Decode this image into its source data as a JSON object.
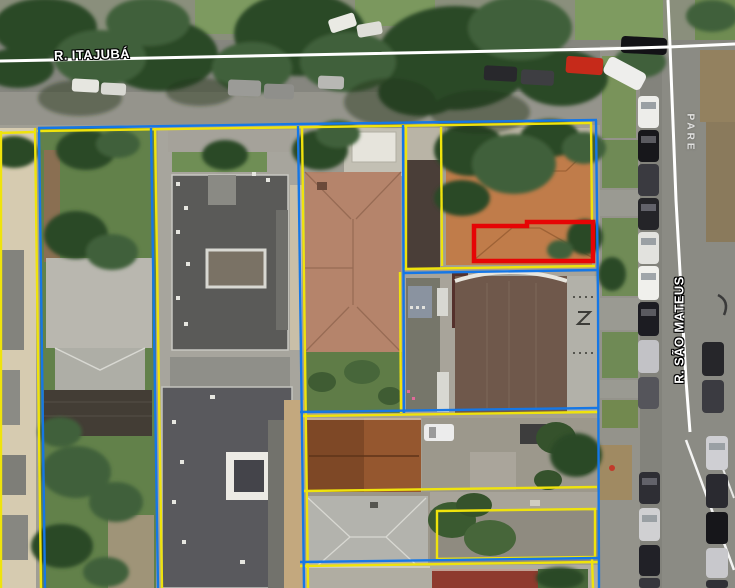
{
  "map": {
    "streets": {
      "horizontal": {
        "label": "R. ITAJUBÁ"
      },
      "vertical": {
        "label": "R. SÃO MATEUS"
      }
    },
    "road_markings": {
      "pare": "PARE"
    },
    "overlay_colors": {
      "parcel_blue": "#1577E6",
      "parcel_yellow": "#EFE30C",
      "selected_red": "#E60505",
      "street_line": "#FFFFFF",
      "label_text": "#FFFFFF",
      "label_outline": "#000000"
    }
  }
}
